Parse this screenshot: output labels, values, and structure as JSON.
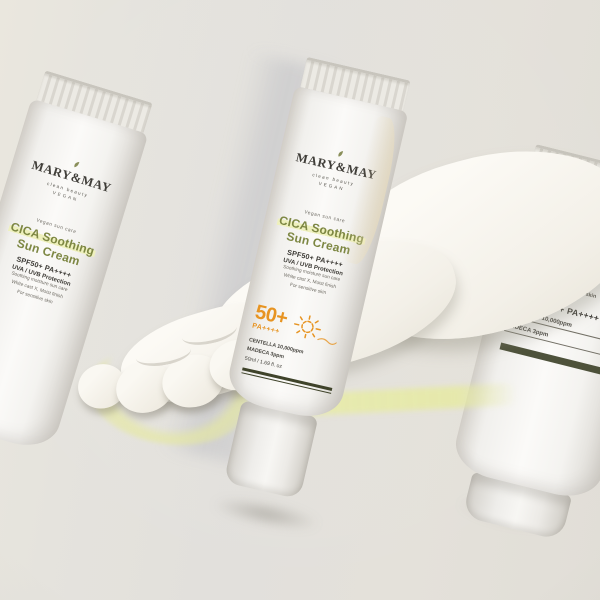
{
  "scene": {
    "description": "Product photo of MARY&MAY CICA Soothing Sun Cream tubes on a beige backdrop with a cream smear swoosh",
    "background_color": "#e3e1db"
  },
  "theme": {
    "orange": "#e79422",
    "olive_text": "#7d8743",
    "name_highlight": "#eef0bd",
    "dark_text": "#3c3a35",
    "small_text": "#6f6c64",
    "rule_olive": "#3f432a",
    "yellow_streak": "#e8eca8"
  },
  "product": {
    "brand": "MARY&MAY",
    "brand_tagline": "clean beauty",
    "brand_badge": "vegan",
    "pre_line": "Vegan sun care",
    "name_line1": "CICA Soothing",
    "name_line2": "Sun Cream",
    "spf_line": "SPF50+ PA++++",
    "uv_line": "UVA / UVB Protection",
    "desc_lines": [
      "Soothing moisture sun care",
      "White cast X, Moist finish",
      "For sensitive skin"
    ],
    "extra_lines": [
      "White cast X",
      "Moist & healthy skin"
    ],
    "badge_spf": "50+",
    "badge_pa": "PA++++",
    "ingredient_lines": [
      "CENTELLA 10,000ppm",
      "MADECA 3ppm"
    ],
    "volume": "50ml / 1.69 fl. oz"
  }
}
